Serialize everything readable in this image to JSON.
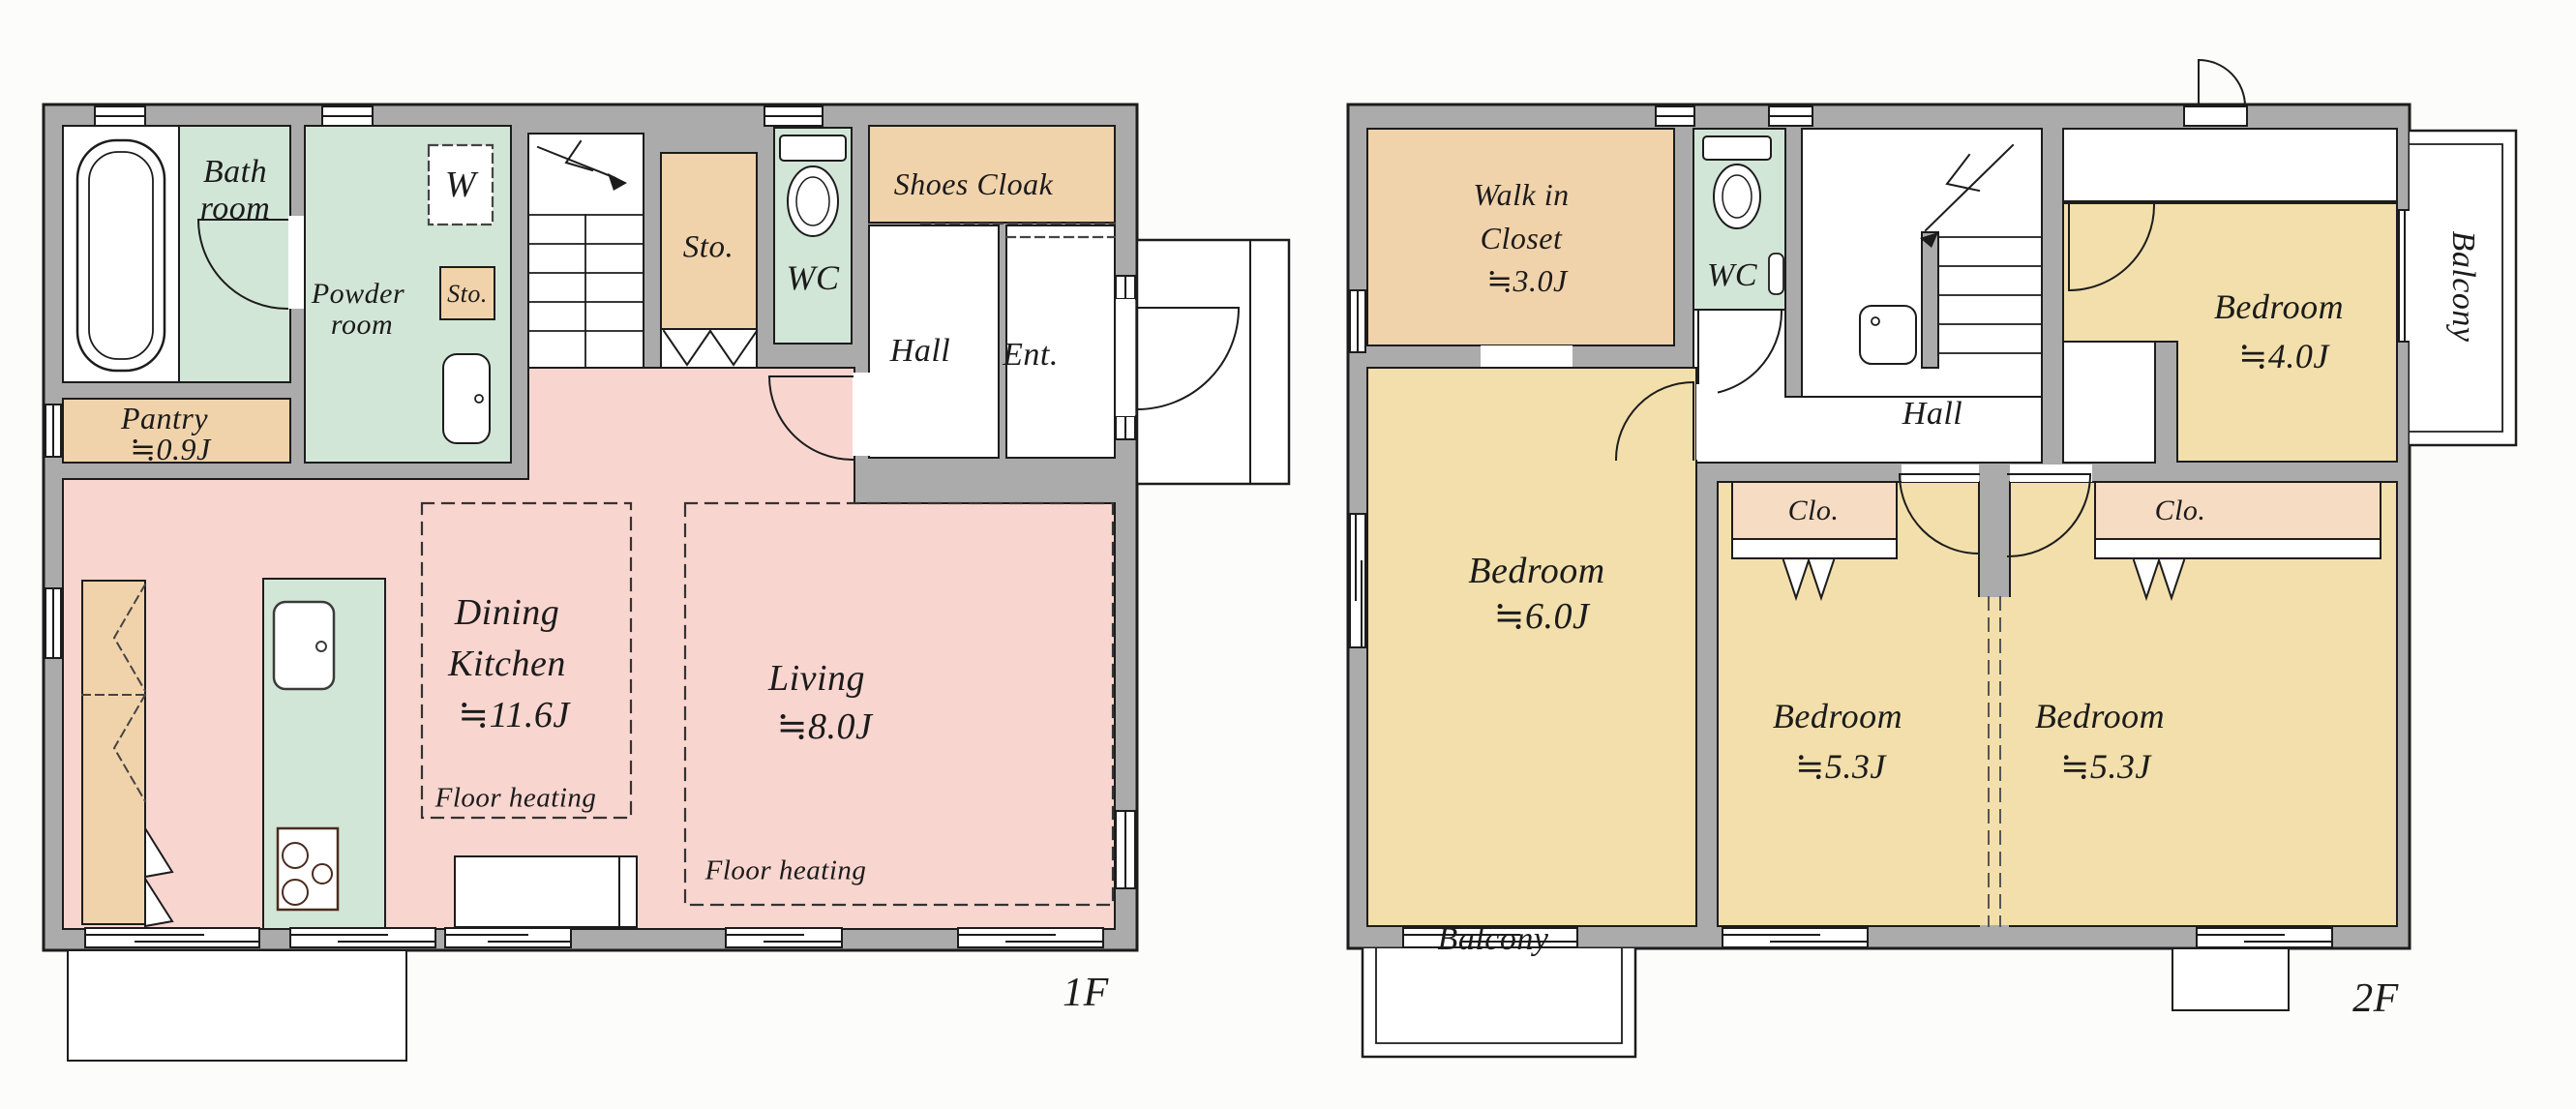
{
  "document": {
    "type": "floor-plan",
    "floors_shown": [
      "1F",
      "2F"
    ]
  },
  "colors": {
    "wall_gray": "#ababab",
    "line": "#1c1c1c",
    "ldk_pink": "#f8d6cf",
    "wet_green": "#d2e6d7",
    "storage_tan": "#f1d3ab",
    "closet_tan": "#f6dcc3",
    "bedroom_yellow": "#f2dfab",
    "background": "#fcfcfa"
  },
  "f1": {
    "floor_label": "1F",
    "bath_line1": "Bath",
    "bath_line2": "room",
    "pantry_line1": "Pantry",
    "pantry_line2": "≒0.9J",
    "powder_line1": "Powder",
    "powder_line2": "room",
    "washer": "W",
    "sto_small": "Sto.",
    "sto": "Sto.",
    "wc": "WC",
    "shoes_cloak": "Shoes Cloak",
    "hall": "Hall",
    "ent": "Ent.",
    "dk_line1": "Dining",
    "dk_line2": "Kitchen",
    "dk_line3": "≒11.6J",
    "dk_floor_heating": "Floor heating",
    "living_line1": "Living",
    "living_line2": "≒8.0J",
    "living_floor_heating": "Floor heating"
  },
  "f2": {
    "floor_label": "2F",
    "wic_line1": "Walk in",
    "wic_line2": "Closet",
    "wic_line3": "≒3.0J",
    "wc": "WC",
    "hall": "Hall",
    "bedroom4_line1": "Bedroom",
    "bedroom4_line2": "≒4.0J",
    "bedroom6_line1": "Bedroom",
    "bedroom6_line2": "≒6.0J",
    "bedroom5a_line1": "Bedroom",
    "bedroom5a_line2": "≒5.3J",
    "bedroom5b_line1": "Bedroom",
    "bedroom5b_line2": "≒5.3J",
    "clo_left": "Clo.",
    "clo_right": "Clo.",
    "balcony_right": "Balcony",
    "balcony_bottom": "Balcony"
  }
}
